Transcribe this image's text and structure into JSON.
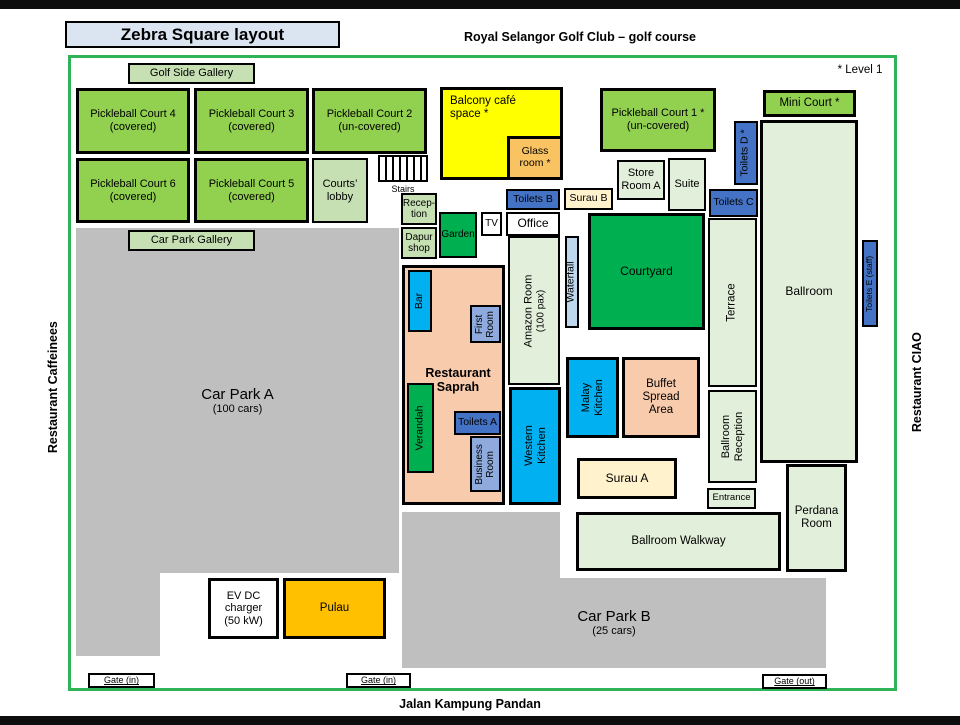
{
  "header": {
    "title": "Zebra Square layout",
    "subtitle": "Royal Selangor Golf Club – golf course",
    "level_note": "* Level 1"
  },
  "surroundings": {
    "left": "Restaurant Caffeinees",
    "right": "Restaurant CIAO",
    "bottom": "Jalan Kampung Pandan"
  },
  "gates": {
    "in1": "Gate (in)",
    "in2": "Gate (in)",
    "out": "Gate (out)"
  },
  "rooms": {
    "golf_side_gallery": {
      "label": "Golf Side Gallery"
    },
    "court4": {
      "label": "Pickleball Court 4",
      "sub": "(covered)"
    },
    "court3": {
      "label": "Pickleball Court 3",
      "sub": "(covered)"
    },
    "court2": {
      "label": "Pickleball Court 2",
      "sub": "(un-covered)"
    },
    "court1": {
      "label": "Pickleball Court 1 *",
      "sub": "(un-covered)"
    },
    "court6": {
      "label": "Pickleball Court 6",
      "sub": "(covered)"
    },
    "court5": {
      "label": "Pickleball Court 5",
      "sub": "(covered)"
    },
    "mini_court": {
      "label": "Mini Court *"
    },
    "balcony_cafe": {
      "label": "Balcony café",
      "sub": "space *"
    },
    "glass_room": {
      "label": "Glass",
      "sub": "room *"
    },
    "courts_lobby": {
      "label": "Courts’",
      "sub": "lobby"
    },
    "stairs": {
      "label": "Stairs"
    },
    "reception": {
      "label": "Recep-",
      "sub": "tion"
    },
    "dapur_shop": {
      "label": "Dapur",
      "sub": "shop"
    },
    "garden": {
      "label": "Garden"
    },
    "tv": {
      "label": "TV"
    },
    "office": {
      "label": "Office"
    },
    "toilets_b": {
      "label": "Toilets B"
    },
    "surau_b": {
      "label": "Surau B"
    },
    "store_room_a": {
      "label": "Store",
      "sub": "Room A"
    },
    "suite": {
      "label": "Suite"
    },
    "toilets_c": {
      "label": "Toilets C"
    },
    "toilets_d": {
      "label": "Toilets D *"
    },
    "toilets_e": {
      "label": "Toilets E (staff)"
    },
    "ballroom": {
      "label": "Ballroom"
    },
    "courtyard": {
      "label": "Courtyard"
    },
    "waterfall": {
      "label": "Waterfall"
    },
    "amazon_room": {
      "label": "Amazon Room",
      "sub": "(100 pax)"
    },
    "terrace": {
      "label": "Terrace"
    },
    "car_park_gallery": {
      "label": "Car Park Gallery"
    },
    "car_park_a": {
      "label": "Car Park A",
      "sub": "(100 cars)"
    },
    "saprah": {
      "label": "Restaurant",
      "sub": "Saprah"
    },
    "bar": {
      "label": "Bar"
    },
    "first_room": {
      "label": "First",
      "sub": "Room"
    },
    "verandah": {
      "label": "Verandah"
    },
    "toilets_a": {
      "label": "Toilets A"
    },
    "business_room": {
      "label": "Business",
      "sub": "Room"
    },
    "western_kitchen": {
      "label": "Western",
      "sub": "Kitchen"
    },
    "malay_kitchen": {
      "label": "Malay",
      "sub": "Kitchen"
    },
    "buffet": {
      "label": "Buffet",
      "sub": "Spread",
      "sub2": "Area"
    },
    "surau_a": {
      "label": "Surau A"
    },
    "ballroom_reception": {
      "label": "Ballroom",
      "sub": "Reception"
    },
    "entrance": {
      "label": "Entrance"
    },
    "perdana": {
      "label": "Perdana",
      "sub": "Room"
    },
    "ballroom_walkway": {
      "label": "Ballroom Walkway"
    },
    "car_park_b": {
      "label": "Car Park B",
      "sub": "(25 cars)"
    },
    "ev_charger": {
      "label": "EV DC",
      "sub": "charger",
      "sub2": "(50 kW)"
    },
    "pulau": {
      "label": "Pulau"
    }
  },
  "palette": {
    "court_green": "#92d050",
    "deep_green": "#00b050",
    "pale_green": "#e2efda",
    "gallery_green": "#c6e0b4",
    "toilet_blue": "#4472c4",
    "kitchen_cyan": "#00b0f0",
    "periwinkle_blue": "#8faadc",
    "waterfall_blue": "#bdd7ee",
    "cream": "#fff2cc",
    "peach": "#f8cbad",
    "yellow": "#ffff00",
    "gold": "#ffc000",
    "glass_gold": "#fac361",
    "carpark_gray": "#bfbfbf",
    "title_blue": "#dbe5f1",
    "map_border_green": "#2eb457"
  }
}
